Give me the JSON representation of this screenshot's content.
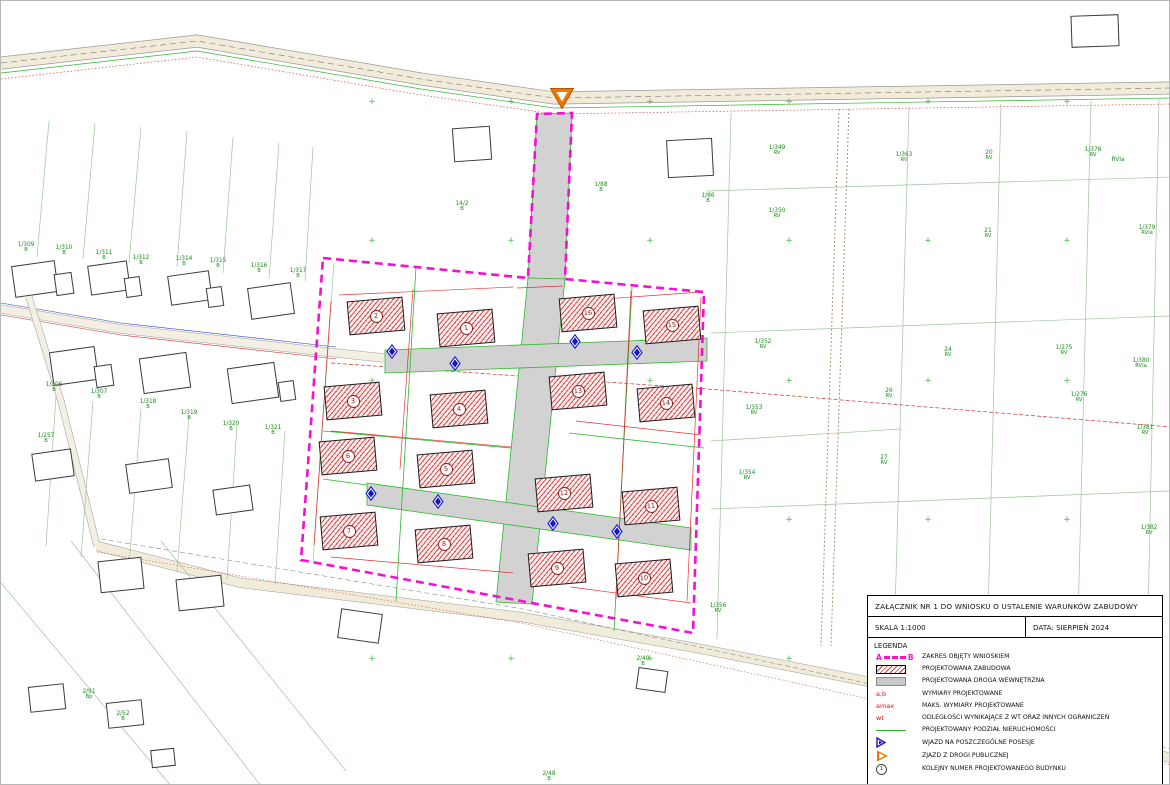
{
  "title_block": {
    "title": "ZAŁĄCZNIK NR 1 DO WNIOSKU O USTALENIE WARUNKÓW ZABUDOWY",
    "scale": "SKALA 1:1000",
    "date": "DATA: SIERPIEŃ 2024",
    "legend_heading": "LEGENDA",
    "legend": [
      {
        "sym": "range",
        "a": "A",
        "b": "B",
        "label": "ZAKRES OBJĘTY WNIOSKIEM"
      },
      {
        "sym": "hatch",
        "label": "PROJEKTOWANA ZABUDOWA"
      },
      {
        "sym": "road",
        "label": "PROJEKTOWANA DROGA WEWNĘTRZNA"
      },
      {
        "sym": "redtext",
        "sym_text": "a,b",
        "label": "WYMIARY PROJEKTOWANE"
      },
      {
        "sym": "redtext",
        "sym_text": "amax",
        "label": "MAKS. WYMIARY PROJEKTOWANE"
      },
      {
        "sym": "redtext",
        "sym_text": "wt",
        "label": "ODLEGŁOŚCI WYNIKAJĄCE Z WT ORAZ INNYCH OGRANICZEŃ"
      },
      {
        "sym": "greenline",
        "label": "PROJEKTOWANY PODZIAŁ NIERUCHOMOŚCI"
      },
      {
        "sym": "bluetri",
        "label": "WJAZD NA POSZCZEGÓLNE POSESJE"
      },
      {
        "sym": "orangetri",
        "label": "ZJAZD Z DROGI PUBLICZNEJ"
      },
      {
        "sym": "circlenum",
        "sym_text": "1",
        "label": "KOLEJNY NUMER PROJEKTOWANEGO BUDYNKU"
      }
    ]
  },
  "map": {
    "colors": {
      "boundary_magenta": "#f50fd0",
      "building_hatch_red": "#d23c3c",
      "road_fill_gray": "#d2d2d2",
      "division_green": "#2db82d",
      "parcel_label_green": "#1a8c1a",
      "dimension_red": "#e01414",
      "entry_blue": "#1414c8",
      "exit_orange": "#f07800"
    },
    "streets": [
      {
        "name": "Osiedlna",
        "x": 292,
        "y": 42,
        "r": 9
      },
      {
        "name": "Osiedlna",
        "x": 972,
        "y": 85,
        "r": -1
      },
      {
        "name": "Popularna",
        "x": 484,
        "y": 605,
        "r": 9
      }
    ],
    "buildings": [
      {
        "n": "1",
        "x": 437,
        "y": 310
      },
      {
        "n": "2",
        "x": 347,
        "y": 298
      },
      {
        "n": "3",
        "x": 324,
        "y": 383
      },
      {
        "n": "4",
        "x": 430,
        "y": 391
      },
      {
        "n": "5",
        "x": 417,
        "y": 451
      },
      {
        "n": "6",
        "x": 319,
        "y": 438
      },
      {
        "n": "7",
        "x": 320,
        "y": 513
      },
      {
        "n": "8",
        "x": 415,
        "y": 526
      },
      {
        "n": "9",
        "x": 528,
        "y": 550
      },
      {
        "n": "10",
        "x": 615,
        "y": 560
      },
      {
        "n": "11",
        "x": 622,
        "y": 488
      },
      {
        "n": "12",
        "x": 535,
        "y": 475
      },
      {
        "n": "13",
        "x": 549,
        "y": 373
      },
      {
        "n": "14",
        "x": 637,
        "y": 385
      },
      {
        "n": "15",
        "x": 643,
        "y": 307
      },
      {
        "n": "16",
        "x": 559,
        "y": 295
      }
    ],
    "houses": [
      {
        "x": 12,
        "y": 262,
        "w": 44,
        "h": 32,
        "r": -8
      },
      {
        "x": 54,
        "y": 272,
        "w": 18,
        "h": 22,
        "r": -8
      },
      {
        "x": 88,
        "y": 262,
        "w": 40,
        "h": 30,
        "r": -8
      },
      {
        "x": 124,
        "y": 276,
        "w": 16,
        "h": 20,
        "r": -8
      },
      {
        "x": 168,
        "y": 272,
        "w": 42,
        "h": 30,
        "r": -8
      },
      {
        "x": 206,
        "y": 286,
        "w": 16,
        "h": 20,
        "r": -8
      },
      {
        "x": 248,
        "y": 284,
        "w": 44,
        "h": 32,
        "r": -8
      },
      {
        "x": 50,
        "y": 348,
        "w": 46,
        "h": 34,
        "r": -8
      },
      {
        "x": 94,
        "y": 364,
        "w": 18,
        "h": 22,
        "r": -8
      },
      {
        "x": 140,
        "y": 354,
        "w": 48,
        "h": 36,
        "r": -8
      },
      {
        "x": 228,
        "y": 364,
        "w": 48,
        "h": 36,
        "r": -8
      },
      {
        "x": 278,
        "y": 380,
        "w": 16,
        "h": 20,
        "r": -8
      },
      {
        "x": 32,
        "y": 450,
        "w": 40,
        "h": 28,
        "r": -8
      },
      {
        "x": 126,
        "y": 460,
        "w": 44,
        "h": 30,
        "r": -8
      },
      {
        "x": 213,
        "y": 486,
        "w": 38,
        "h": 26,
        "r": -8
      },
      {
        "x": 98,
        "y": 558,
        "w": 44,
        "h": 32,
        "r": -6
      },
      {
        "x": 176,
        "y": 576,
        "w": 46,
        "h": 32,
        "r": -6
      },
      {
        "x": 28,
        "y": 684,
        "w": 36,
        "h": 26,
        "r": -6
      },
      {
        "x": 106,
        "y": 700,
        "w": 36,
        "h": 26,
        "r": -6
      },
      {
        "x": 150,
        "y": 748,
        "w": 24,
        "h": 18,
        "r": -6
      },
      {
        "x": 452,
        "y": 126,
        "w": 38,
        "h": 34,
        "r": -4
      },
      {
        "x": 666,
        "y": 138,
        "w": 46,
        "h": 38,
        "r": -3
      },
      {
        "x": 1070,
        "y": 14,
        "w": 48,
        "h": 32,
        "r": -2
      },
      {
        "x": 636,
        "y": 668,
        "w": 30,
        "h": 22,
        "r": 8
      },
      {
        "x": 338,
        "y": 610,
        "w": 42,
        "h": 30,
        "r": 8
      }
    ],
    "parcel_labels": [
      {
        "t": "1/309",
        "cls": "B",
        "x": 25,
        "y": 241
      },
      {
        "t": "1/310",
        "cls": "B",
        "x": 63,
        "y": 244
      },
      {
        "t": "1/311",
        "cls": "B",
        "x": 103,
        "y": 249
      },
      {
        "t": "1/312",
        "cls": "B",
        "x": 140,
        "y": 254
      },
      {
        "t": "1/314",
        "cls": "B",
        "x": 183,
        "y": 255
      },
      {
        "t": "1/315",
        "cls": "B",
        "x": 217,
        "y": 257
      },
      {
        "t": "1/316",
        "cls": "B",
        "x": 258,
        "y": 262
      },
      {
        "t": "1/317",
        "cls": "B",
        "x": 297,
        "y": 267
      },
      {
        "t": "1/306",
        "cls": "B",
        "x": 53,
        "y": 381
      },
      {
        "t": "1/307",
        "cls": "B",
        "x": 98,
        "y": 388
      },
      {
        "t": "1/318",
        "cls": "B",
        "x": 147,
        "y": 398
      },
      {
        "t": "1/319",
        "cls": "B",
        "x": 188,
        "y": 409
      },
      {
        "t": "1/320",
        "cls": "B",
        "x": 230,
        "y": 420
      },
      {
        "t": "1/321",
        "cls": "B",
        "x": 272,
        "y": 424
      },
      {
        "t": "1/257",
        "cls": "B",
        "x": 45,
        "y": 432
      },
      {
        "t": "2/91",
        "cls": "Bp",
        "x": 88,
        "y": 688
      },
      {
        "t": "2/52",
        "cls": "B",
        "x": 122,
        "y": 710
      },
      {
        "t": "14/2",
        "cls": "B",
        "x": 461,
        "y": 200
      },
      {
        "t": "1/88",
        "cls": "B",
        "x": 600,
        "y": 181
      },
      {
        "t": "1/86",
        "cls": "B",
        "x": 707,
        "y": 192
      },
      {
        "t": "1/349",
        "cls": "RV",
        "x": 776,
        "y": 144
      },
      {
        "t": "1/350",
        "cls": "RV",
        "x": 776,
        "y": 207
      },
      {
        "t": "1/363",
        "cls": "RV",
        "x": 903,
        "y": 151
      },
      {
        "t": "20",
        "cls": "RV",
        "x": 988,
        "y": 149
      },
      {
        "t": "21",
        "cls": "RV",
        "x": 987,
        "y": 227
      },
      {
        "t": "1/378",
        "cls": "RV",
        "x": 1092,
        "y": 146
      },
      {
        "t": "RVIa",
        "cls": "",
        "x": 1117,
        "y": 156
      },
      {
        "t": "1/379",
        "cls": "RVIa",
        "x": 1146,
        "y": 224
      },
      {
        "t": "1/352",
        "cls": "RV",
        "x": 762,
        "y": 338
      },
      {
        "t": "1/353",
        "cls": "RV",
        "x": 753,
        "y": 404
      },
      {
        "t": "1/354",
        "cls": "RV",
        "x": 746,
        "y": 469
      },
      {
        "t": "24",
        "cls": "RV",
        "x": 947,
        "y": 346
      },
      {
        "t": "26",
        "cls": "RV",
        "x": 888,
        "y": 387
      },
      {
        "t": "27",
        "cls": "RV",
        "x": 883,
        "y": 454
      },
      {
        "t": "1/275",
        "cls": "RV",
        "x": 1063,
        "y": 344
      },
      {
        "t": "1/276",
        "cls": "RV",
        "x": 1078,
        "y": 391
      },
      {
        "t": "1/380",
        "cls": "RVIa",
        "x": 1140,
        "y": 357
      },
      {
        "t": "1/381",
        "cls": "RV",
        "x": 1144,
        "y": 424
      },
      {
        "t": "1/382",
        "cls": "RV",
        "x": 1148,
        "y": 524
      },
      {
        "t": "1/357",
        "cls": "RV",
        "x": 1056,
        "y": 617
      },
      {
        "t": "1/358",
        "cls": "RV",
        "x": 1040,
        "y": 648
      },
      {
        "t": "1/356",
        "cls": "RV",
        "x": 717,
        "y": 602
      },
      {
        "t": "2/40",
        "cls": "B",
        "x": 642,
        "y": 655
      },
      {
        "t": "2/48",
        "cls": "B",
        "x": 548,
        "y": 770
      }
    ],
    "dim_labels": [
      {
        "t": "25",
        "x": 476,
        "y": 289,
        "s": 10
      },
      {
        "t": "10",
        "x": 530,
        "y": 283,
        "s": 8
      },
      {
        "t": "5",
        "x": 549,
        "y": 288,
        "s": 7
      },
      {
        "t": "33",
        "x": 632,
        "y": 277,
        "s": 9
      },
      {
        "t": "12",
        "x": 398,
        "y": 417,
        "s": 8
      },
      {
        "t": "10",
        "x": 510,
        "y": 452,
        "s": 8
      },
      {
        "t": "5",
        "x": 534,
        "y": 457,
        "s": 7
      },
      {
        "t": "min. 8",
        "x": 564,
        "y": 598,
        "s": 8
      },
      {
        "t": "min.8",
        "x": 603,
        "y": 599,
        "s": 8
      },
      {
        "t": "amax",
        "x": 338,
        "y": 507,
        "s": 7
      },
      {
        "t": "wt",
        "x": 400,
        "y": 285
      },
      {
        "t": "wt",
        "x": 430,
        "y": 284
      },
      {
        "t": "wt",
        "x": 502,
        "y": 300
      },
      {
        "t": "wt",
        "x": 608,
        "y": 300
      },
      {
        "t": "wt",
        "x": 641,
        "y": 285
      },
      {
        "t": "wt",
        "x": 668,
        "y": 288
      },
      {
        "t": "wt",
        "x": 314,
        "y": 405
      },
      {
        "t": "wt",
        "x": 354,
        "y": 400
      },
      {
        "t": "wt",
        "x": 324,
        "y": 542
      },
      {
        "t": "wt",
        "x": 608,
        "y": 421
      },
      {
        "t": "wt",
        "x": 624,
        "y": 421
      },
      {
        "t": "wt",
        "x": 669,
        "y": 468
      },
      {
        "t": "a",
        "x": 374,
        "y": 288
      },
      {
        "t": "b",
        "x": 408,
        "y": 344
      },
      {
        "t": "a",
        "x": 466,
        "y": 295
      },
      {
        "t": "b",
        "x": 498,
        "y": 370
      },
      {
        "t": "a",
        "x": 596,
        "y": 291
      },
      {
        "t": "b",
        "x": 626,
        "y": 358
      }
    ],
    "survey_marks": [
      {
        "t": "75.08",
        "x": 238,
        "y": 74,
        "c": "#d03030"
      },
      {
        "t": "73.48",
        "x": 304,
        "y": 82,
        "c": "#d03030"
      },
      {
        "t": "74.86",
        "x": 418,
        "y": 91,
        "c": "#d03030"
      },
      {
        "t": "76.02",
        "x": 466,
        "y": 98,
        "c": "#d03030"
      },
      {
        "t": "80.23",
        "x": 514,
        "y": 117,
        "c": "#d03030"
      },
      {
        "t": "77.87",
        "x": 514,
        "y": 124,
        "c": "#d03030"
      },
      {
        "t": "63.25",
        "x": 596,
        "y": 104,
        "c": "#d03030"
      },
      {
        "t": "75.86",
        "x": 696,
        "y": 100,
        "c": "#d03030"
      },
      {
        "t": "83.19",
        "x": 756,
        "y": 96,
        "c": "#d03030"
      },
      {
        "t": "74.12",
        "x": 876,
        "y": 92,
        "c": "#d03030"
      },
      {
        "t": "75.40",
        "x": 956,
        "y": 116,
        "c": "#d03030"
      },
      {
        "t": "71.35",
        "x": 1116,
        "y": 86,
        "c": "#d03030"
      },
      {
        "t": "78.45",
        "x": 583,
        "y": 118,
        "c": "#d03030"
      },
      {
        "t": "62.05",
        "x": 146,
        "y": 116,
        "c": "#2b43c8"
      },
      {
        "t": "41.18",
        "x": 86,
        "y": 296,
        "c": "#2b43c8"
      },
      {
        "t": "44.04",
        "x": 256,
        "y": 326,
        "c": "#2b43c8"
      },
      {
        "t": "83.44",
        "x": 196,
        "y": 341,
        "c": "#2b43c8"
      },
      {
        "t": "61.18",
        "x": 336,
        "y": 331,
        "c": "#2b43c8"
      },
      {
        "t": "52.33",
        "x": 936,
        "y": 58,
        "c": "#2b43c8"
      },
      {
        "t": "63.25",
        "x": 118,
        "y": 316,
        "c": "#d03030"
      },
      {
        "t": "82.75",
        "x": 40,
        "y": 328,
        "c": "#d03030"
      }
    ],
    "house_labels": [
      {
        "t": "23",
        "x": 1086,
        "y": 24
      },
      {
        "t": "m2",
        "x": 464,
        "y": 148
      },
      {
        "t": "m1",
        "x": 682,
        "y": 164
      },
      {
        "t": "m2",
        "x": 48,
        "y": 284
      },
      {
        "t": "m2",
        "x": 156,
        "y": 368
      },
      {
        "t": "m2",
        "x": 244,
        "y": 376
      },
      {
        "t": "m1",
        "x": 112,
        "y": 578
      },
      {
        "t": "m2",
        "x": 30,
        "y": 564
      },
      {
        "t": "m3",
        "x": 350,
        "y": 620
      }
    ],
    "grid_crosses": [
      {
        "x": 371,
        "y": 101
      },
      {
        "x": 510,
        "y": 101
      },
      {
        "x": 649,
        "y": 101
      },
      {
        "x": 788,
        "y": 101
      },
      {
        "x": 927,
        "y": 101
      },
      {
        "x": 1066,
        "y": 101
      },
      {
        "x": 371,
        "y": 240
      },
      {
        "x": 510,
        "y": 240
      },
      {
        "x": 649,
        "y": 240
      },
      {
        "x": 788,
        "y": 240
      },
      {
        "x": 927,
        "y": 240
      },
      {
        "x": 1066,
        "y": 240
      },
      {
        "x": 371,
        "y": 380
      },
      {
        "x": 649,
        "y": 380
      },
      {
        "x": 788,
        "y": 380
      },
      {
        "x": 927,
        "y": 380
      },
      {
        "x": 1066,
        "y": 380
      },
      {
        "x": 371,
        "y": 519
      },
      {
        "x": 788,
        "y": 519
      },
      {
        "x": 927,
        "y": 519
      },
      {
        "x": 1066,
        "y": 519
      },
      {
        "x": 371,
        "y": 658
      },
      {
        "x": 510,
        "y": 658
      },
      {
        "x": 649,
        "y": 658
      },
      {
        "x": 788,
        "y": 658
      }
    ],
    "entry_markers": [
      {
        "x": 385,
        "y": 343
      },
      {
        "x": 448,
        "y": 355
      },
      {
        "x": 568,
        "y": 333
      },
      {
        "x": 630,
        "y": 344
      },
      {
        "x": 364,
        "y": 485
      },
      {
        "x": 431,
        "y": 493
      },
      {
        "x": 546,
        "y": 515
      },
      {
        "x": 610,
        "y": 523
      }
    ],
    "exit_markers": [
      {
        "x": 548,
        "y": 86
      }
    ]
  }
}
